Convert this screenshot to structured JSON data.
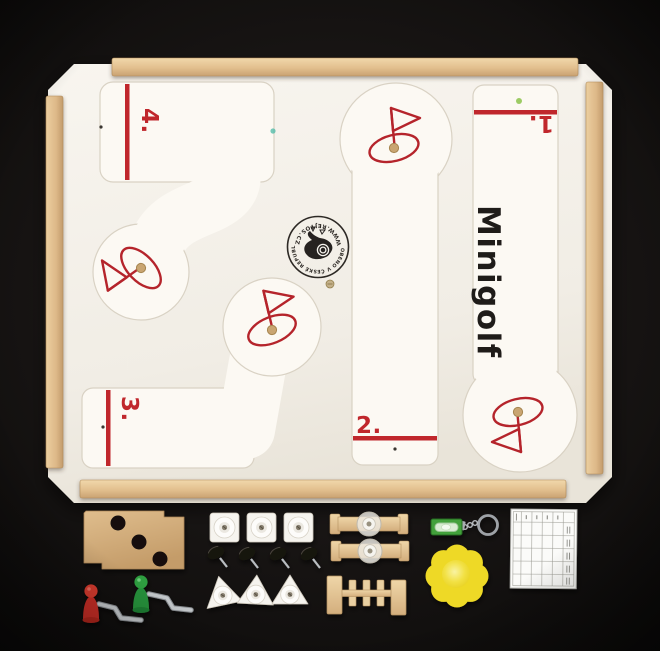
{
  "board": {
    "title": "Minigolf",
    "hole_labels": {
      "h1": "1.",
      "h2": "2.",
      "h3": "3.",
      "h4": "4."
    },
    "stamp": {
      "arc_top": "VYROBENO V ČESKÉ REPUBLICE",
      "arc_bottom": "WWW.REJTOS.CZ"
    },
    "colors": {
      "accent_red": "#c0272c",
      "board_face": "#f4f1ea",
      "track_face": "#fcf9f3",
      "wood_rail": "#e2c093",
      "background": "#141110",
      "mdf_tan": "#d2ab78",
      "piece_red": "#d0342c",
      "piece_green": "#2f9e3f",
      "level_green": "#42a13b",
      "sponge_yellow": "#f0dc30"
    },
    "icons": {
      "flag": "golf-hole-flag-icon",
      "stamp_bird": "maker-stamp-bird-icon"
    }
  },
  "pieces": {
    "inventory": [
      "mdf-spacer-board",
      "golf-club-figure-red",
      "golf-club-figure-green",
      "square-obstacle-x3",
      "black-knob-screw-x4",
      "triangle-obstacle-x3",
      "suction-cup-bar-x2",
      "windmill-gate-obstacle",
      "spirit-level-keychain",
      "sponge-flower-ball",
      "score-card"
    ]
  }
}
